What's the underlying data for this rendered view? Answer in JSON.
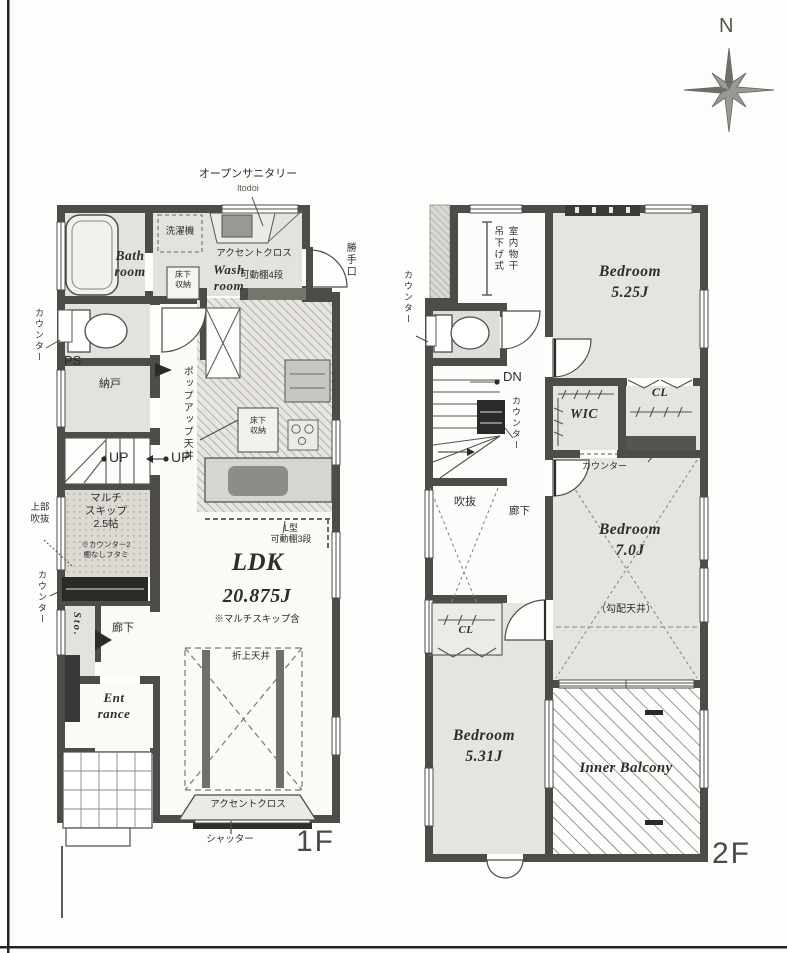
{
  "compass": {
    "north_label": "N"
  },
  "floor1": {
    "floor_label": "1F",
    "open_sanitary": "オープンサニタリー",
    "open_sanitary_sub": "ltodoi",
    "washer": "洗濯機",
    "accent_cross_top": "アクセントクロス",
    "bath_room": "Bath\nroom",
    "wash_room": "Wash\nroom",
    "underfloor_storage_wash": "床下\n収納",
    "movable_shelf_4": "可動棚4段",
    "back_door": "勝手口",
    "counter_upper_left": "カウンター",
    "ps": "PS",
    "storeroom": "納戸",
    "up_left": "UP",
    "up_right": "UP",
    "popup_ceiling": "ポップアップ天井",
    "underfloor_storage_kitchen": "床下\n収納",
    "l_shelf": "L型\n可動棚3段",
    "ldk": "LDK",
    "ldk_size": "20.875J",
    "ldk_note": "※マルチスキップ含",
    "multi_skip": "マルチ\nスキップ\n2.5帖",
    "multi_skip_note": "※カウンター2\n棚なしフタミ",
    "upper_void": "上部\n吹抜",
    "counter_lower_left": "カウンター",
    "sto": "Sto.",
    "hallway": "廊下",
    "entrance": "Ent\nrance",
    "raised_ceiling": "折上天井",
    "accent_cross_bottom": "アクセントクロス",
    "shutter": "シャッター"
  },
  "floor2": {
    "floor_label": "2F",
    "indoor_drying": "室内物干\n吊下げ式",
    "bedroom_a": "Bedroom\n5.25J",
    "counter_wc": "カウンター",
    "dn": "DN",
    "counter_stairs": "カウンター",
    "wic": "WIC",
    "cl_upper": "CL",
    "counter_mid": "カウンター",
    "void": "吹抜",
    "hallway": "廊下",
    "bedroom_b": "Bedroom\n7.0J",
    "sloped_ceiling": "（勾配天井）",
    "cl_lower": "CL",
    "bedroom_c": "Bedroom\n5.31J",
    "inner_balcony": "Inner Balcony"
  }
}
